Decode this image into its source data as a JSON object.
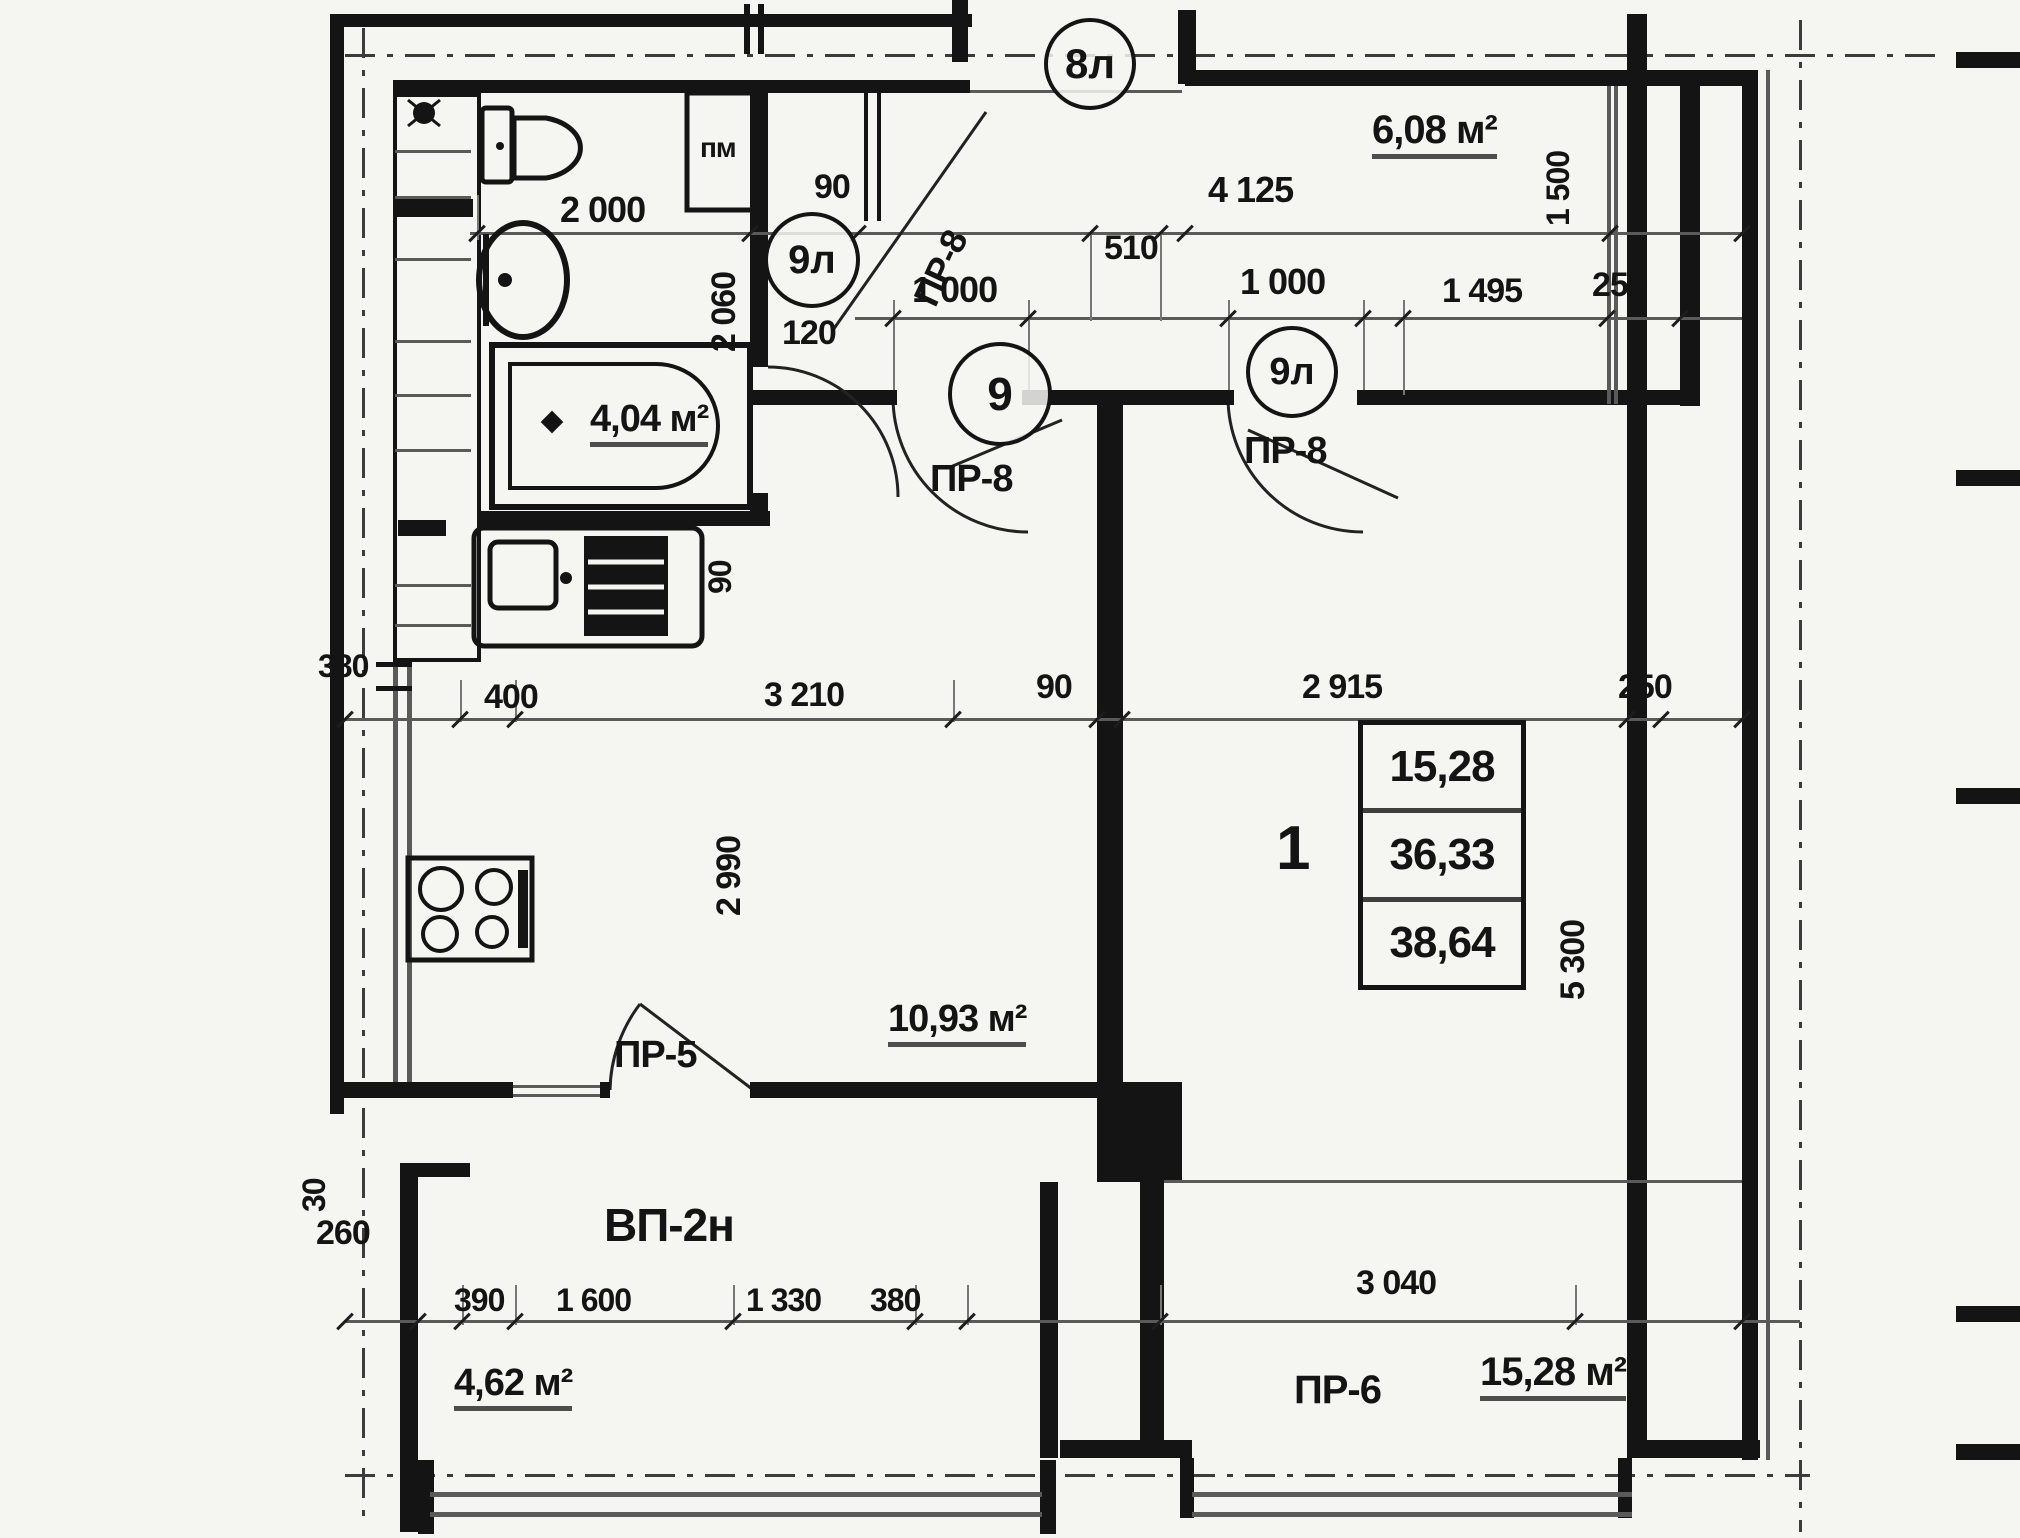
{
  "plan": {
    "title": "apartment-floor-plan",
    "axes": {
      "top": "8л",
      "bath": "9л",
      "hall": "9",
      "room": "9л"
    },
    "areas": {
      "bathroom": "4,04 м²",
      "loggia": "6,08 м²",
      "kitchen": "10,93 м²",
      "balcony": "4,62 м²",
      "room": "15,28 м²"
    },
    "table": {
      "living": "15,28",
      "total": "36,33",
      "overall": "38,64"
    },
    "room_number": "1",
    "doors": {
      "pr8_entry": "ПР-8",
      "pr8_hall": "ПР-8",
      "pr8_room": "ПР-8",
      "pr5": "ПР-5",
      "pr6": "ПР-6",
      "balcony_type": "ВП-2н"
    },
    "equipment": {
      "washing_machine": "пм"
    },
    "dims": {
      "d2000": "2 000",
      "d90top": "90",
      "d4125": "4 125",
      "d510": "510",
      "d1000a": "1 000",
      "d1000b": "1 000",
      "d1495": "1 495",
      "d250top": "250",
      "d120": "120",
      "d2060": "2 060",
      "d1500": "1 500",
      "d90sink": "90",
      "d380left": "380",
      "d400": "400",
      "d3210": "3 210",
      "d90mid": "90",
      "d2915": "2 915",
      "d250mid": "250",
      "d2990": "2 990",
      "d5300": "5 300",
      "d30": "30",
      "d260": "260",
      "d390": "390",
      "d1600": "1 600",
      "d1330": "1 330",
      "d380b": "380",
      "d3040": "3 040"
    },
    "colors": {
      "ink": "#141414",
      "paper": "#f5f5f2",
      "dimline": "#5a5a5a"
    }
  }
}
